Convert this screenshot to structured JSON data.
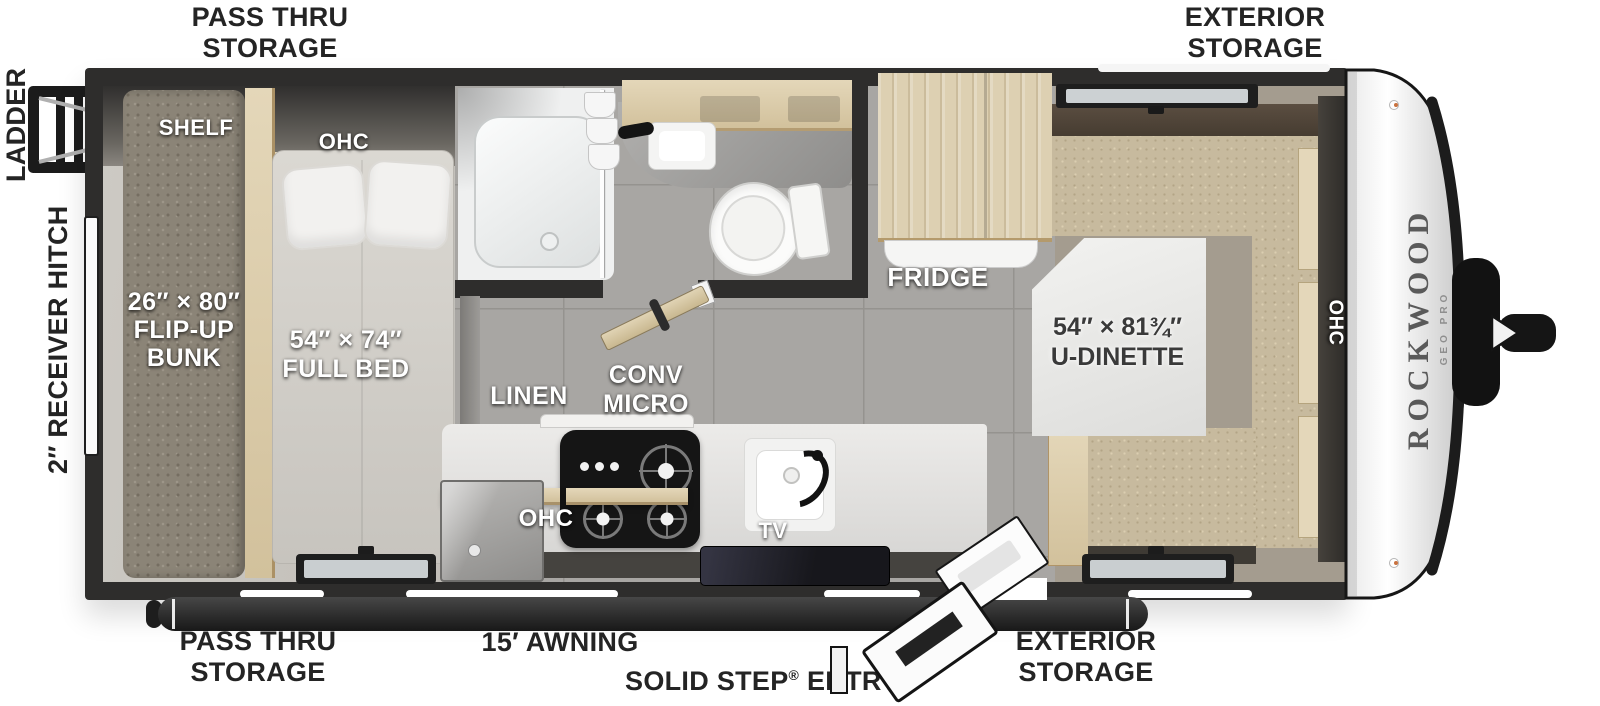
{
  "title": "Rockwood Geo Pro travel trailer floor plan",
  "labels": {
    "top_left": [
      "PASS THRU",
      "STORAGE"
    ],
    "top_right": [
      "EXTERIOR",
      "STORAGE"
    ],
    "ladder": "LADDER",
    "hitch": "2″ RECEIVER HITCH",
    "bottom_left": [
      "PASS THRU",
      "STORAGE"
    ],
    "awning": "15′ AWNING",
    "entry": {
      "pre": "SOLID STEP",
      "reg": "®",
      "post": " ENTRY"
    },
    "bottom_right": [
      "EXTERIOR",
      "STORAGE"
    ]
  },
  "room": {
    "shelf": "SHELF",
    "bed_ohc": "OHC",
    "bunk": [
      "26″ × 80″",
      "FLIP-UP",
      "BUNK"
    ],
    "bed": [
      "54″ × 74″",
      "FULL BED"
    ],
    "linen": "LINEN",
    "micro": [
      "CONV",
      "MICRO"
    ],
    "kitchen_ohc": "OHC",
    "tv": "TV",
    "fridge": "FRIDGE",
    "dinette": [
      "54″ × 81¾″",
      "U-DINETTE"
    ],
    "dinette_ohc": "OHC"
  },
  "brand": {
    "make": "ROCKWOOD",
    "model": "GEO PRO"
  },
  "colors": {
    "wall": "#2e2d2c",
    "tile_floor": "#a8a6a3",
    "bedroom_floor": "#c8c5bf",
    "wood": "#ddd0b2",
    "cushion": "#c7ba9e",
    "label_dark": "#242424",
    "label_light": "#ffffff"
  }
}
